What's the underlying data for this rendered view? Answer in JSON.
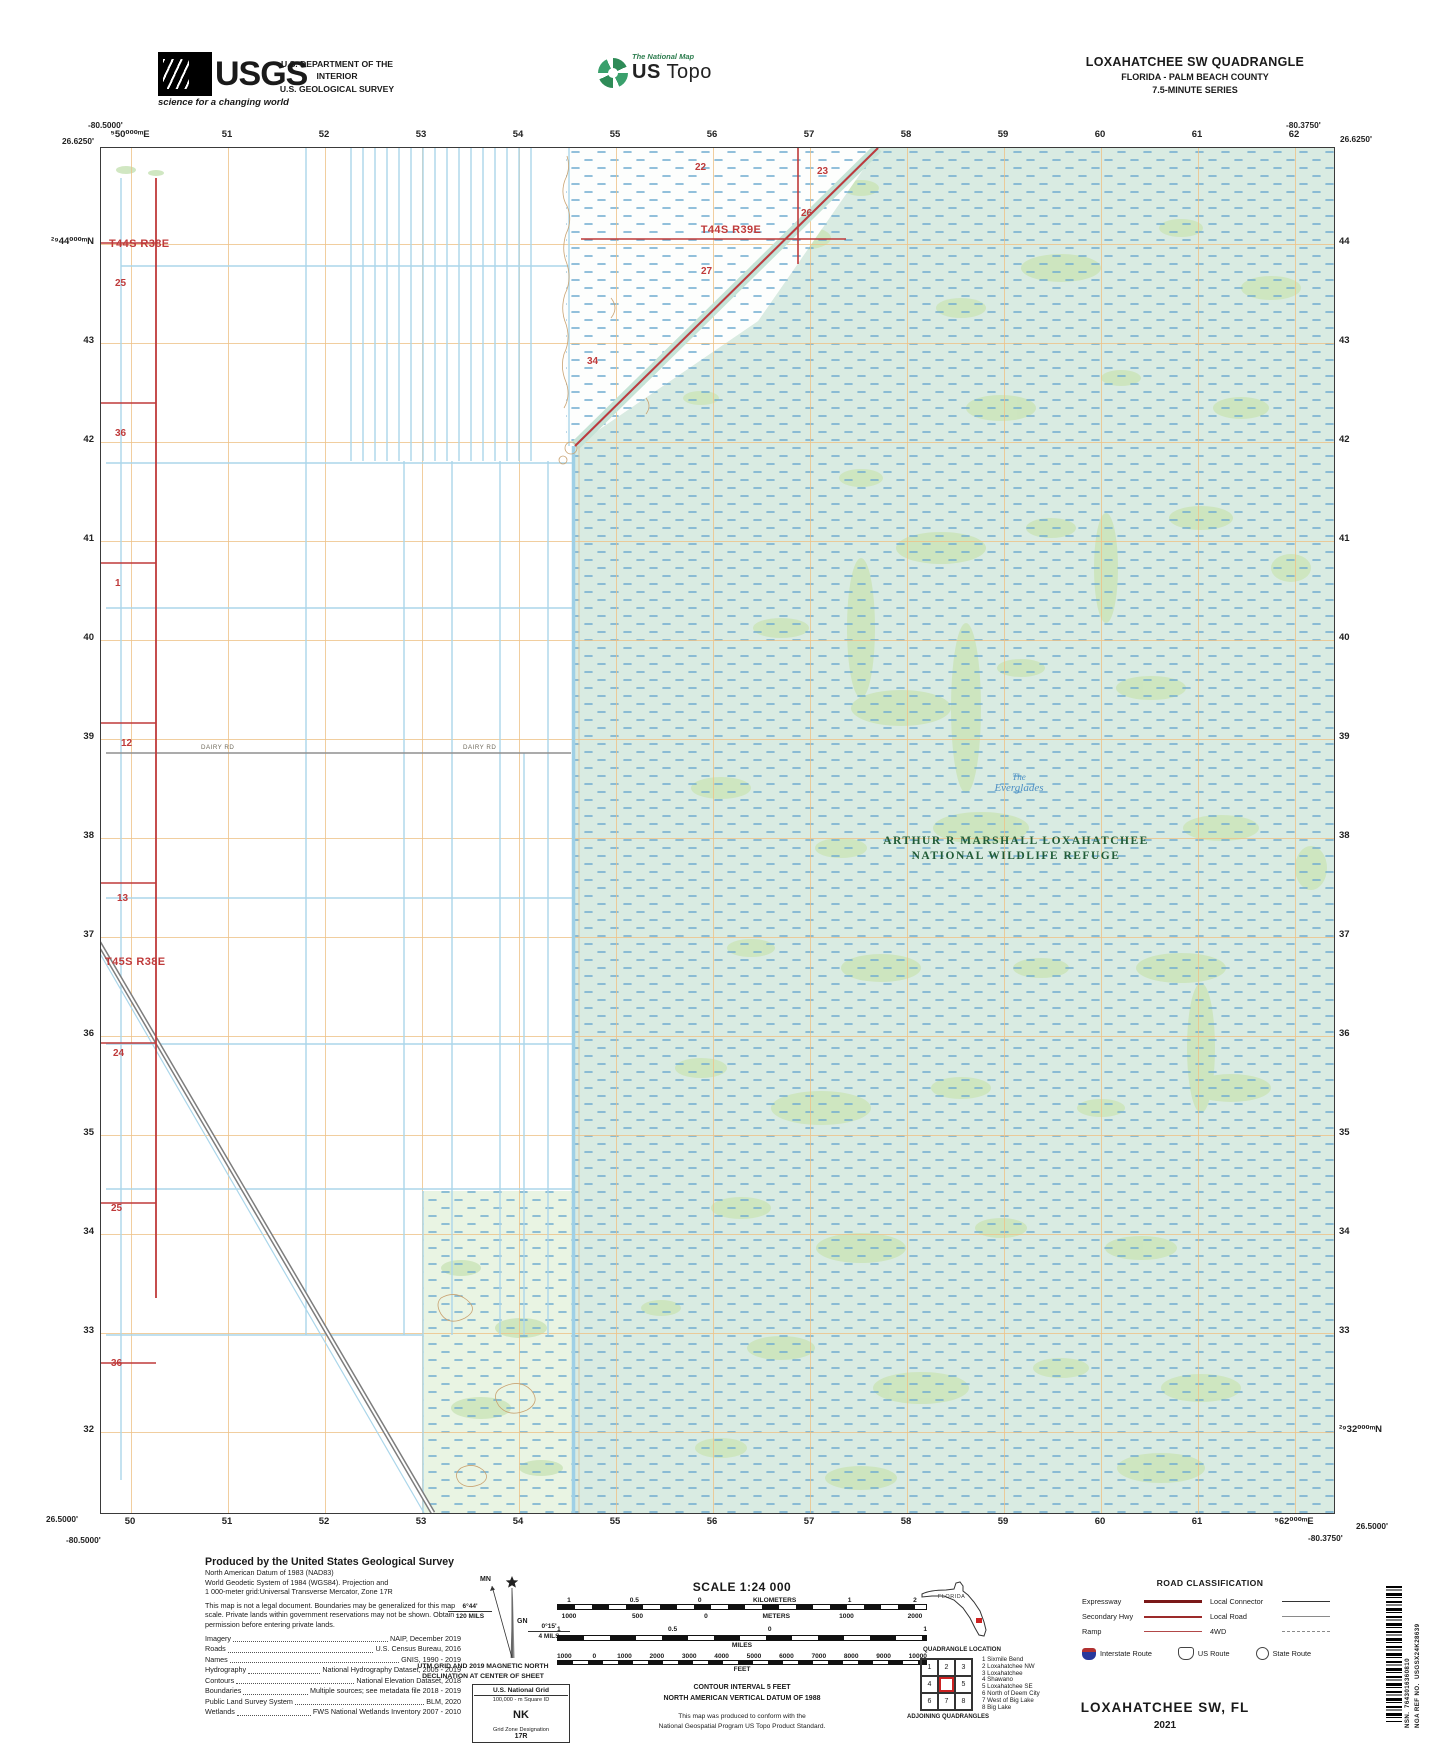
{
  "header": {
    "usgs": {
      "brand": "USGS",
      "tagline": "science for a changing world"
    },
    "department_line1": "U.S. DEPARTMENT OF THE INTERIOR",
    "department_line2": "U.S. GEOLOGICAL SURVEY",
    "national_map": {
      "small_label": "The National Map",
      "big_label_bold": "US",
      "big_label_rest": " Topo"
    },
    "quad_title": "LOXAHATCHEE SW QUADRANGLE",
    "quad_subtitle": "FLORIDA - PALM BEACH COUNTY",
    "quad_series": "7.5-MINUTE SERIES"
  },
  "map": {
    "corners": {
      "top_left_lon": "-80.5000'",
      "top_left_lat": "26.6250'",
      "top_right_lon": "-80.3750'",
      "top_right_lat": "26.6250'",
      "bottom_left_lat": "26.5000'",
      "bottom_left_lon": "-80.5000'",
      "bottom_right_lon": "-80.3750'",
      "bottom_right_lat": "26.5000'"
    },
    "grid": {
      "top": [
        "⁵50⁰⁰⁰ᵐE",
        "51",
        "52",
        "53",
        "54",
        "55",
        "56",
        "57",
        "58",
        "59",
        "60",
        "61",
        "62"
      ],
      "bottom": [
        "50",
        "51",
        "52",
        "53",
        "54",
        "55",
        "56",
        "57",
        "58",
        "59",
        "60",
        "61",
        "⁵62⁰⁰⁰ᵐE"
      ],
      "left": [
        "²⁹44⁰⁰⁰ᵐN",
        "43",
        "42",
        "41",
        "40",
        "39",
        "38",
        "37",
        "36",
        "35",
        "34",
        "33",
        "32"
      ],
      "right": [
        "44",
        "43",
        "42",
        "41",
        "40",
        "39",
        "38",
        "37",
        "36",
        "35",
        "34",
        "33",
        "²⁹32⁰⁰⁰ᵐN"
      ]
    },
    "labels": {
      "township_t44s_r38e": "T44S R38E",
      "township_t44s_r39e": "T44S R39E",
      "township_t45s_r38e": "T45S R38E",
      "sections_left": [
        "25",
        "36",
        "1",
        "12",
        "13",
        "24",
        "25",
        "36"
      ],
      "sections_marsh": [
        "22",
        "23",
        "26",
        "27",
        "34"
      ],
      "refuge_line1": "ARTHUR R MARSHALL LOXAHATCHEE",
      "refuge_line2": "NATIONAL WILDLIFE REFUGE",
      "everglades_line1": "The",
      "everglades_line2": "Everglades",
      "dairy_rd": "DAIRY RD"
    }
  },
  "footer": {
    "credits": {
      "title": "Produced by the United States Geological Survey",
      "lines": [
        "North American Datum of 1983 (NAD83)",
        "World Geodetic System of 1984 (WGS84).  Projection and",
        "1 000-meter grid:Universal Transverse Mercator, Zone 17R"
      ],
      "disclaimer": "This map is not a legal document. Boundaries may be generalized for this map scale. Private lands within government reservations may not be shown. Obtain permission before entering private lands.",
      "sources": [
        {
          "label": "Imagery",
          "value": "NAIP, December 2019"
        },
        {
          "label": "Roads",
          "value": "U.S. Census Bureau, 2016"
        },
        {
          "label": "Names",
          "value": "GNIS, 1990 - 2019"
        },
        {
          "label": "Hydrography",
          "value": "National Hydrography Dataset, 2005 - 2019"
        },
        {
          "label": "Contours",
          "value": "National Elevation Dataset, 2018"
        },
        {
          "label": "Boundaries",
          "value": "Multiple sources; see metadata file 2018 - 2019"
        },
        {
          "label": "Public Land Survey System",
          "value": "BLM, 2020"
        },
        {
          "label": "Wetlands",
          "value": "FWS National Wetlands Inventory 2007 - 2010"
        }
      ]
    },
    "declination": {
      "mn": "MN",
      "gn": "GN",
      "mn_deg": "6°44'",
      "mn_mils": "120 MILS",
      "gn_deg": "0°15'",
      "gn_mils": "4 MILS",
      "caption_line1": "UTM GRID AND 2019 MAGNETIC NORTH",
      "caption_line2": "DECLINATION AT CENTER OF SHEET"
    },
    "usng": {
      "title": "U.S. National Grid",
      "subtitle": "100,000 - m Square ID",
      "square_id": "NK",
      "zone_label": "Grid Zone Designation",
      "zone": "17R"
    },
    "scale": {
      "title": "SCALE 1:24 000",
      "km_row": [
        "1",
        "0.5",
        "0",
        "KILOMETERS",
        "1",
        "2"
      ],
      "m_row": [
        "1000",
        "500",
        "0",
        "METERS",
        "1000",
        "2000"
      ],
      "miles": [
        "1",
        "0.5",
        "0",
        "1"
      ],
      "miles_unit": "MILES",
      "feet": [
        "1000",
        "0",
        "1000",
        "2000",
        "3000",
        "4000",
        "5000",
        "6000",
        "7000",
        "8000",
        "9000",
        "10000"
      ],
      "feet_unit": "FEET",
      "contour_line1": "CONTOUR INTERVAL 5 FEET",
      "contour_line2": "NORTH AMERICAN VERTICAL DATUM OF 1988",
      "note_line1": "This map was produced to conform with the",
      "note_line2": "National Geospatial Program US Topo Product Standard."
    },
    "location": {
      "state_label": "FLORIDA",
      "caption": "QUADRANGLE LOCATION"
    },
    "adjoining": {
      "cells": [
        "1",
        "2",
        "3",
        "4",
        "",
        "5",
        "6",
        "7",
        "8"
      ],
      "list": [
        "1 Sixmile Bend",
        "2 Loxahatchee NW",
        "3 Loxahatchee",
        "4 Shawano",
        "5 Loxahatchee SE",
        "6 North of Deem City",
        "7 West of Big Lake",
        "8 Big Lake"
      ],
      "caption": "ADJOINING QUADRANGLES"
    },
    "road_classification": {
      "title": "ROAD CLASSIFICATION",
      "left_rows": [
        "Expressway",
        "Secondary Hwy",
        "Ramp"
      ],
      "right_rows": [
        "Local Connector",
        "Local Road",
        "4WD"
      ],
      "shields": [
        "Interstate Route",
        "US Route",
        "State Route"
      ]
    },
    "sheet_title": "LOXAHATCHEE SW,  FL",
    "sheet_year": "2021",
    "nsn_label": "NSN.",
    "nsn_value": "7643016360810",
    "nga_label": "NGA REF NO.",
    "nga_value": "USGSX24K28639"
  }
}
